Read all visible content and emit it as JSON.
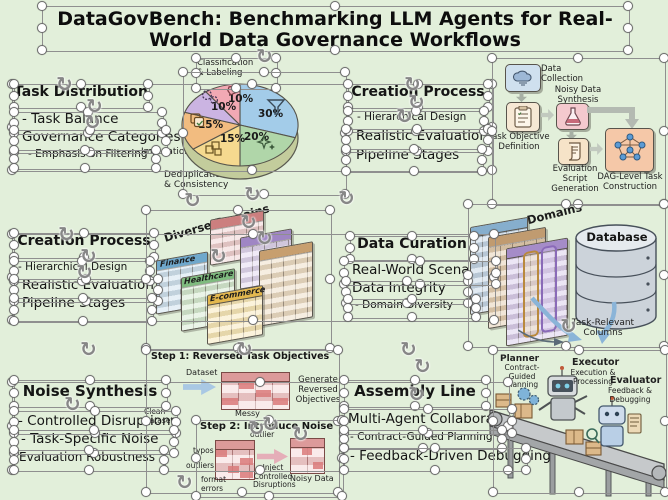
{
  "title": "DataGovBench: Benchmarking LLM Agents for Real-World Data Governance Workflows",
  "panels": {
    "task_distribution": {
      "heading": "Task Distribution",
      "lines": [
        "- Task Balance",
        "Governance Categories",
        "- Emphasis on Filtering"
      ]
    },
    "creation_process_top": {
      "heading": "Creation Process",
      "lines": [
        "- Hierarchical Design",
        "Realistic Evaluation",
        "Pipeline Stages"
      ]
    },
    "creation_process_mid": {
      "heading": "Creation Process",
      "lines": [
        "- Hierarchical Design",
        "Realistic Evaluation",
        "Pipeline Stages"
      ]
    },
    "data_curation": {
      "heading": "Data Curation",
      "lines": [
        "Real-World Scenarios",
        "Data Integrity",
        "- Domain Diversity"
      ]
    },
    "noise_synthesis": {
      "heading": "Noise Synthesis",
      "lines": [
        "- Controlled Disruptions",
        "- Task-Specific Noise",
        "Evaluation Robustness"
      ]
    },
    "assembly_line": {
      "heading": "Assembly Line",
      "lines": [
        "Multi-Agent Collaboration",
        "- Contract-Guided Planning",
        "- Feedback-Driven Debugging"
      ]
    }
  },
  "chart_data": {
    "type": "pie",
    "title": "Task Distribution",
    "slices": [
      {
        "label": "Filtering",
        "pct": "30%",
        "value": 30,
        "color": "#a3cce9",
        "icon": "funnel-icon"
      },
      {
        "label": "",
        "pct": "20%",
        "value": 20,
        "color": "#b0d6a9",
        "icon": "sparkle-icon"
      },
      {
        "label": "Deduplication & Consistency",
        "pct": "15%",
        "value": 15,
        "color": "#f5d98f",
        "icon": "blocks-icon"
      },
      {
        "label": "Imputation",
        "pct": "15%",
        "value": 15,
        "color": "#f2bc80",
        "icon": "copy-icon"
      },
      {
        "label": "",
        "pct": "10%",
        "value": 10,
        "color": "#cbb4e2",
        "icon": "gears-icon"
      },
      {
        "label": "Classification & Labeling",
        "pct": "10%",
        "value": 10,
        "color": "#f2a9b4",
        "icon": "tag-icon"
      }
    ],
    "callouts": {
      "top": "Classification & Labeling",
      "left": "Imputation",
      "bottom": "Deduplication & Consistency"
    },
    "legend_position": "callouts",
    "grid": false
  },
  "flowchart": {
    "nodes": [
      {
        "label": "Data Collection",
        "icon": "cloud-icon"
      },
      {
        "label": "Task Objective Definition",
        "icon": "clipboard-icon"
      },
      {
        "label": "Noisy Data Synthesis",
        "icon": "flask-icon"
      },
      {
        "label": "Evaluation Script Generation",
        "icon": "scroll-icon"
      },
      {
        "label": "DAG-Level Task Construction",
        "icon": "dag-icon"
      }
    ]
  },
  "domains_left": {
    "caption": "Diverse Domains",
    "tables": [
      "Finance",
      "Healthcare",
      "E-commerce"
    ]
  },
  "domains_right": {
    "caption": "Diverse Domains",
    "database_label": "Database",
    "arrow_label": "Task-Relevant Columns"
  },
  "noise_steps": {
    "step1": {
      "heading": "Step 1: Reversed Task Objectives",
      "input_label": "Dataset",
      "table_label": "Messy",
      "output_label": "Generate Reversed Objectives",
      "side_label": "Clean Dataset"
    },
    "step2": {
      "heading": "Step 2: Introduce Noise",
      "annotations": [
        "outlier",
        "typos",
        "outliers",
        "format errors"
      ],
      "arrow_label": "Inject Controlled Disruptions",
      "output_label": "Noisy Data"
    }
  },
  "assembly": {
    "roles": [
      {
        "name": "Planner",
        "desc": "Contract-Guided Planning"
      },
      {
        "name": "Executor",
        "desc": "Execution & Processing"
      },
      {
        "name": "Evaluator",
        "desc": "Feedback & Debugging"
      }
    ]
  },
  "colors": {
    "background": "#e2efda",
    "text": "#151515",
    "selection_line": "#8f8f8f",
    "handle_border": "#6e6e6e",
    "flow_blue": "#cfe0ee",
    "flow_pink": "#f4c9ce",
    "flow_cream": "#f6e8d4",
    "flow_orange": "#f5c8a8",
    "database_gray": "#ccd3da",
    "belt_gray": "#c6c9cb",
    "crate_tan": "#dcb98a"
  },
  "overlay": {
    "rotation_glyph": "↻",
    "selection_boxes": [
      [
        42,
        6,
        586,
        44
      ],
      [
        12,
        84,
        480,
        86
      ],
      [
        12,
        234,
        482,
        86
      ],
      [
        12,
        382,
        496,
        88
      ],
      [
        14,
        84,
        134,
        23
      ],
      [
        14,
        112,
        148,
        21
      ],
      [
        14,
        130,
        152,
        22
      ],
      [
        14,
        150,
        142,
        18
      ],
      [
        196,
        58,
        80,
        30
      ],
      [
        183,
        72,
        162,
        122
      ],
      [
        348,
        84,
        140,
        23
      ],
      [
        348,
        111,
        136,
        20
      ],
      [
        346,
        129,
        142,
        22
      ],
      [
        346,
        149,
        136,
        22
      ],
      [
        492,
        58,
        172,
        146
      ],
      [
        14,
        233,
        140,
        24
      ],
      [
        14,
        261,
        136,
        20
      ],
      [
        14,
        279,
        144,
        22
      ],
      [
        14,
        298,
        138,
        23
      ],
      [
        146,
        210,
        184,
        138
      ],
      [
        350,
        236,
        124,
        23
      ],
      [
        344,
        261,
        152,
        23
      ],
      [
        346,
        281,
        122,
        22
      ],
      [
        348,
        299,
        128,
        18
      ],
      [
        468,
        204,
        196,
        142
      ],
      [
        14,
        380,
        152,
        26
      ],
      [
        14,
        411,
        162,
        22
      ],
      [
        14,
        430,
        160,
        23
      ],
      [
        14,
        450,
        150,
        20
      ],
      [
        146,
        350,
        192,
        142
      ],
      [
        196,
        420,
        146,
        76
      ],
      [
        344,
        380,
        142,
        26
      ],
      [
        344,
        409,
        168,
        24
      ],
      [
        344,
        430,
        158,
        18
      ],
      [
        344,
        448,
        182,
        22
      ],
      [
        493,
        350,
        172,
        142
      ]
    ],
    "rotation_icons": [
      [
        256,
        46
      ],
      [
        56,
        74
      ],
      [
        86,
        96
      ],
      [
        84,
        112
      ],
      [
        184,
        190
      ],
      [
        244,
        184
      ],
      [
        58,
        224
      ],
      [
        80,
        246
      ],
      [
        76,
        262
      ],
      [
        404,
        74
      ],
      [
        408,
        92
      ],
      [
        396,
        106
      ],
      [
        240,
        212
      ],
      [
        256,
        228
      ],
      [
        210,
        246
      ],
      [
        400,
        339
      ],
      [
        414,
        356
      ],
      [
        408,
        384
      ],
      [
        80,
        339
      ],
      [
        236,
        339
      ],
      [
        64,
        394
      ],
      [
        262,
        414
      ],
      [
        292,
        424
      ],
      [
        338,
        188
      ],
      [
        560,
        316
      ],
      [
        248,
        418
      ],
      [
        176,
        472
      ]
    ]
  }
}
